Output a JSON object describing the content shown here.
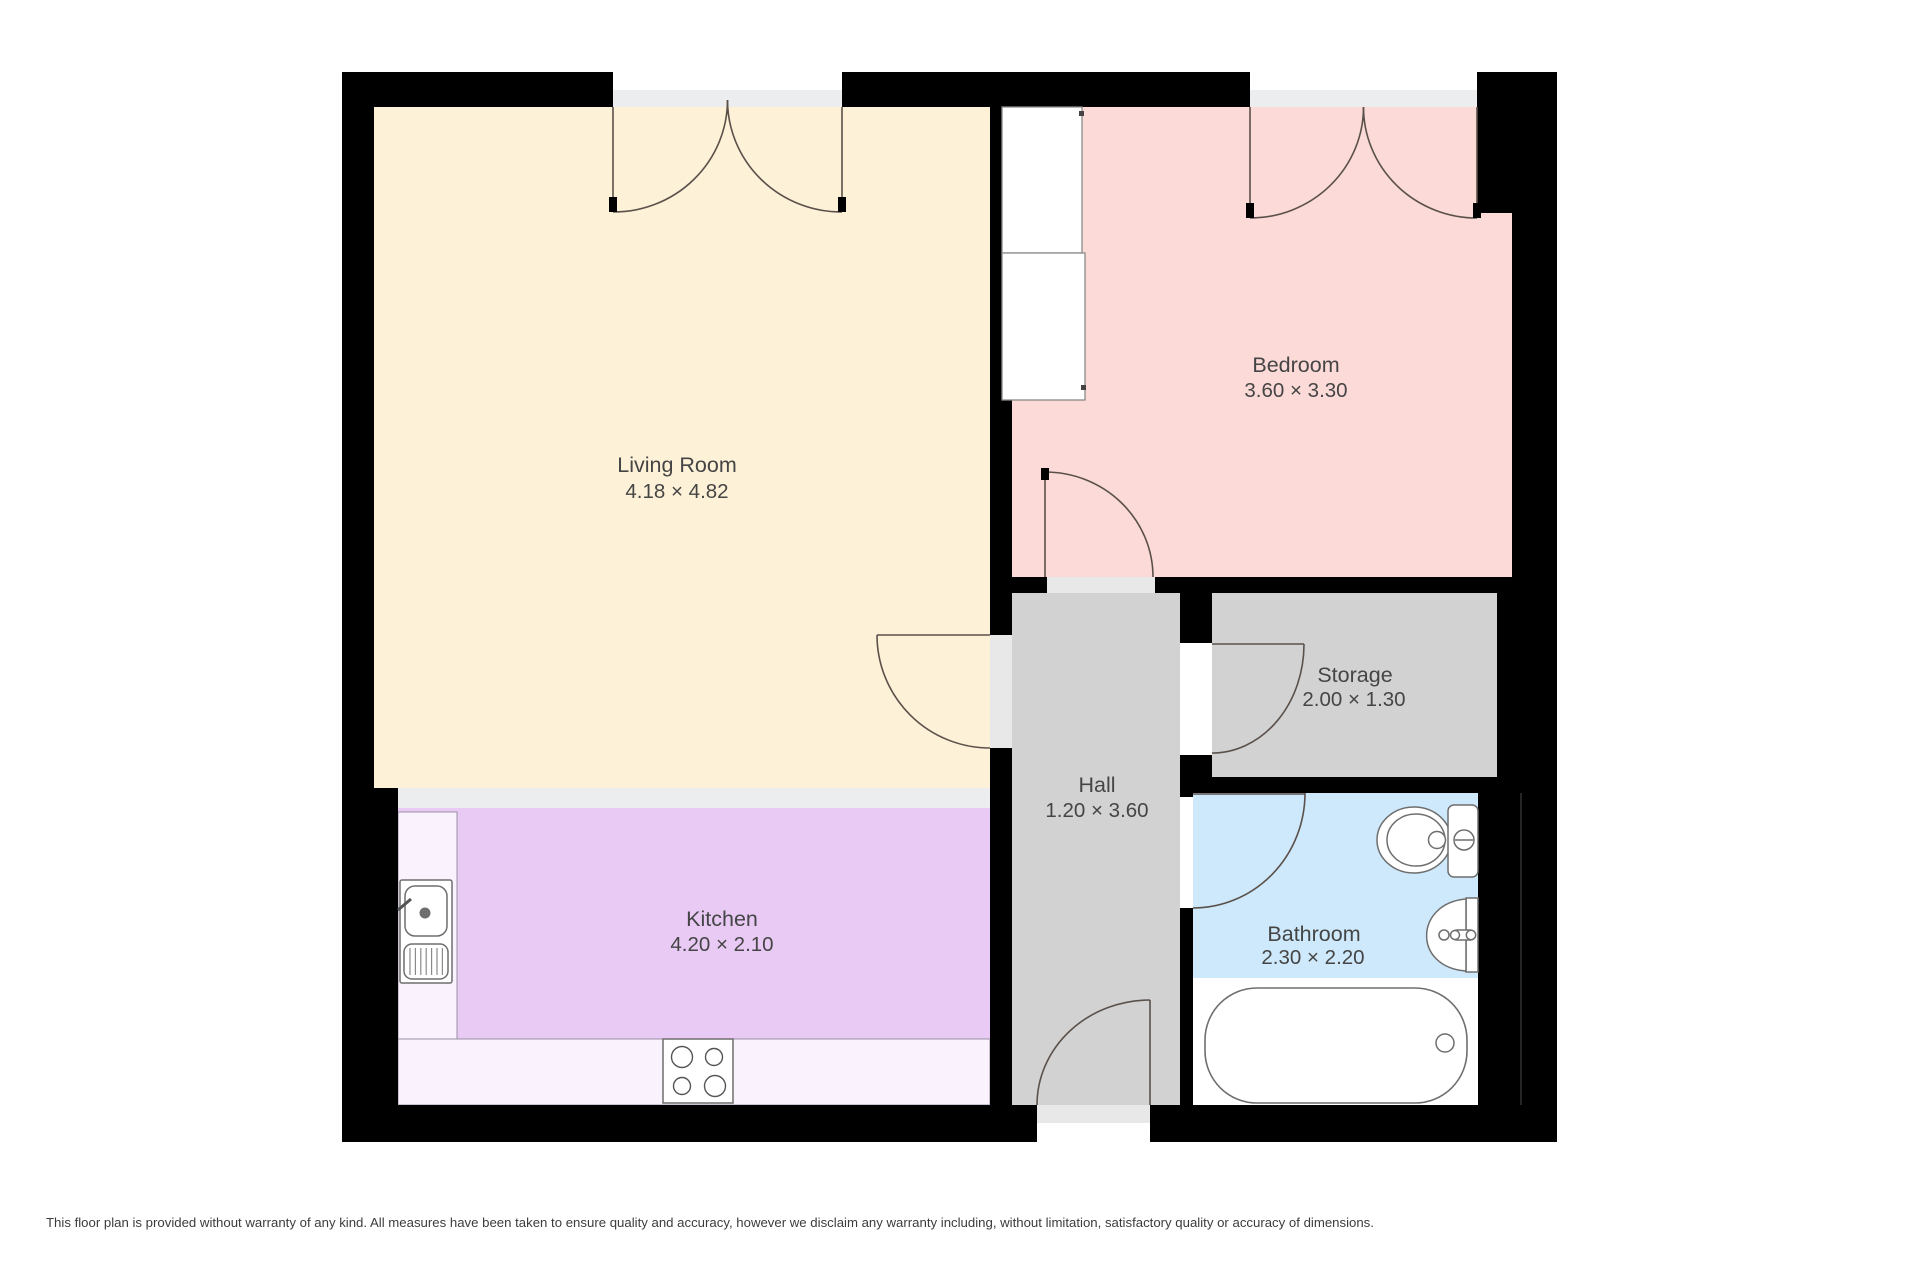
{
  "canvas": {
    "width": 1920,
    "height": 1280,
    "background": "#ffffff"
  },
  "colors": {
    "wall": "#000000",
    "living_room": "#fdf1d7",
    "kitchen": "#e8caf4",
    "kitchen_counter": "#faf3fd",
    "kitchen_divider": "#ebedee",
    "bedroom": "#fcdad8",
    "hall": "#d2d2d2",
    "storage": "#d2d2d2",
    "bathroom": "#cee9fb",
    "threshold": "#e8e8e8",
    "door_swing": "#5b514b",
    "fixture_stroke": "#6e6e6e",
    "label_text": "#454545"
  },
  "rooms": [
    {
      "key": "living-room",
      "name": "Living Room",
      "dims": "4.18 × 4.82"
    },
    {
      "key": "kitchen",
      "name": "Kitchen",
      "dims": "4.20 × 2.10"
    },
    {
      "key": "bedroom",
      "name": "Bedroom",
      "dims": "3.60 × 3.30"
    },
    {
      "key": "hall",
      "name": "Hall",
      "dims": "1.20 × 3.60"
    },
    {
      "key": "storage",
      "name": "Storage",
      "dims": "2.00 × 1.30"
    },
    {
      "key": "bathroom",
      "name": "Bathroom",
      "dims": "2.30 × 2.20"
    }
  ],
  "disclaimer": "This floor plan is provided without warranty of any kind. All measures have been taken to ensure quality and accuracy, however we disclaim any warranty including, without limitation, satisfactory quality or accuracy of dimensions."
}
